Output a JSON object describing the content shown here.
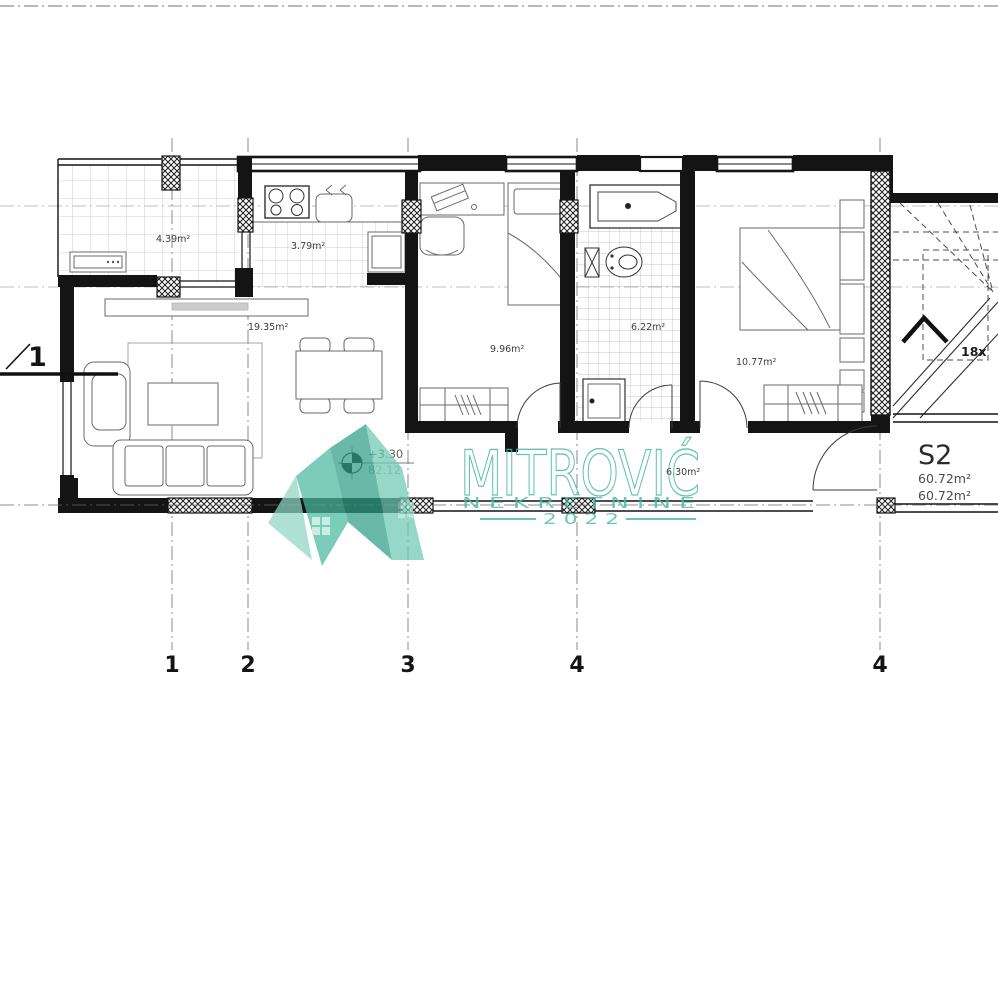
{
  "rooms": {
    "terrace": "4.39m²",
    "kitchen": "3.79m²",
    "living": "19.35m²",
    "bedroom1": "9.96m²",
    "bathroom": "6.22m²",
    "bedroom2": "10.77m²",
    "hall": "6.30m²"
  },
  "unit": {
    "id": "S2",
    "area_line1": "60.72m²",
    "area_line2": "60.72m²"
  },
  "level": {
    "elevation": "+3.30",
    "absolute": "82.12"
  },
  "stairs": {
    "count_note": "18x"
  },
  "axes": {
    "a1": "1",
    "a2": "2",
    "a3": "3",
    "a4": "4",
    "a5": "4",
    "section": "1"
  },
  "watermark": {
    "title": "MITROVIĆ",
    "subtitle": "N E K R E T N I N E",
    "year": "2 0 2 2",
    "accent_color": "#49b9a0"
  }
}
